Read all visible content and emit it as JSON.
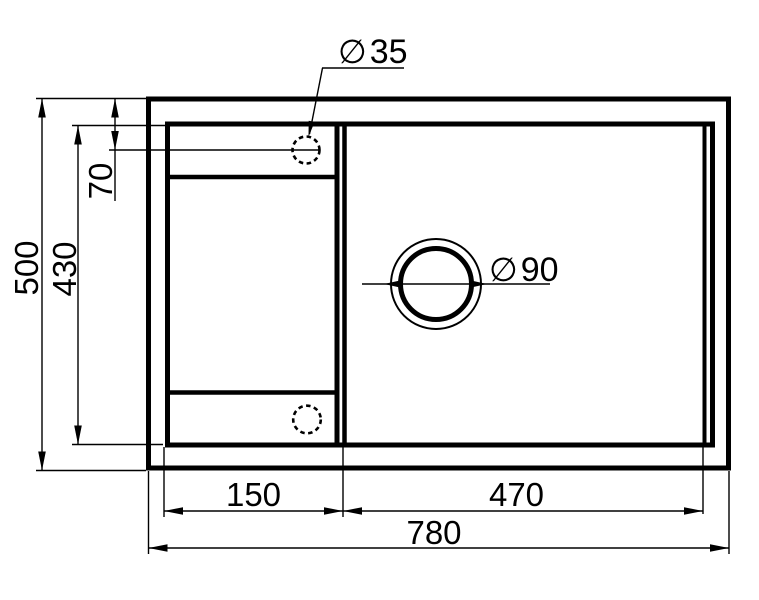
{
  "drawing": {
    "description": "Kitchen sink top-view dimensional drawing",
    "colors": {
      "line": "#000000",
      "background": "#ffffff"
    },
    "dimensions": {
      "total_width": "780",
      "total_height": "500",
      "inner_height": "430",
      "faucet_center_offset": "70",
      "left_section_width": "150",
      "right_section_width": "470"
    },
    "holes": {
      "faucet": {
        "symbol": "∅",
        "value": "35"
      },
      "drain": {
        "symbol": "∅",
        "value": "90"
      }
    }
  }
}
